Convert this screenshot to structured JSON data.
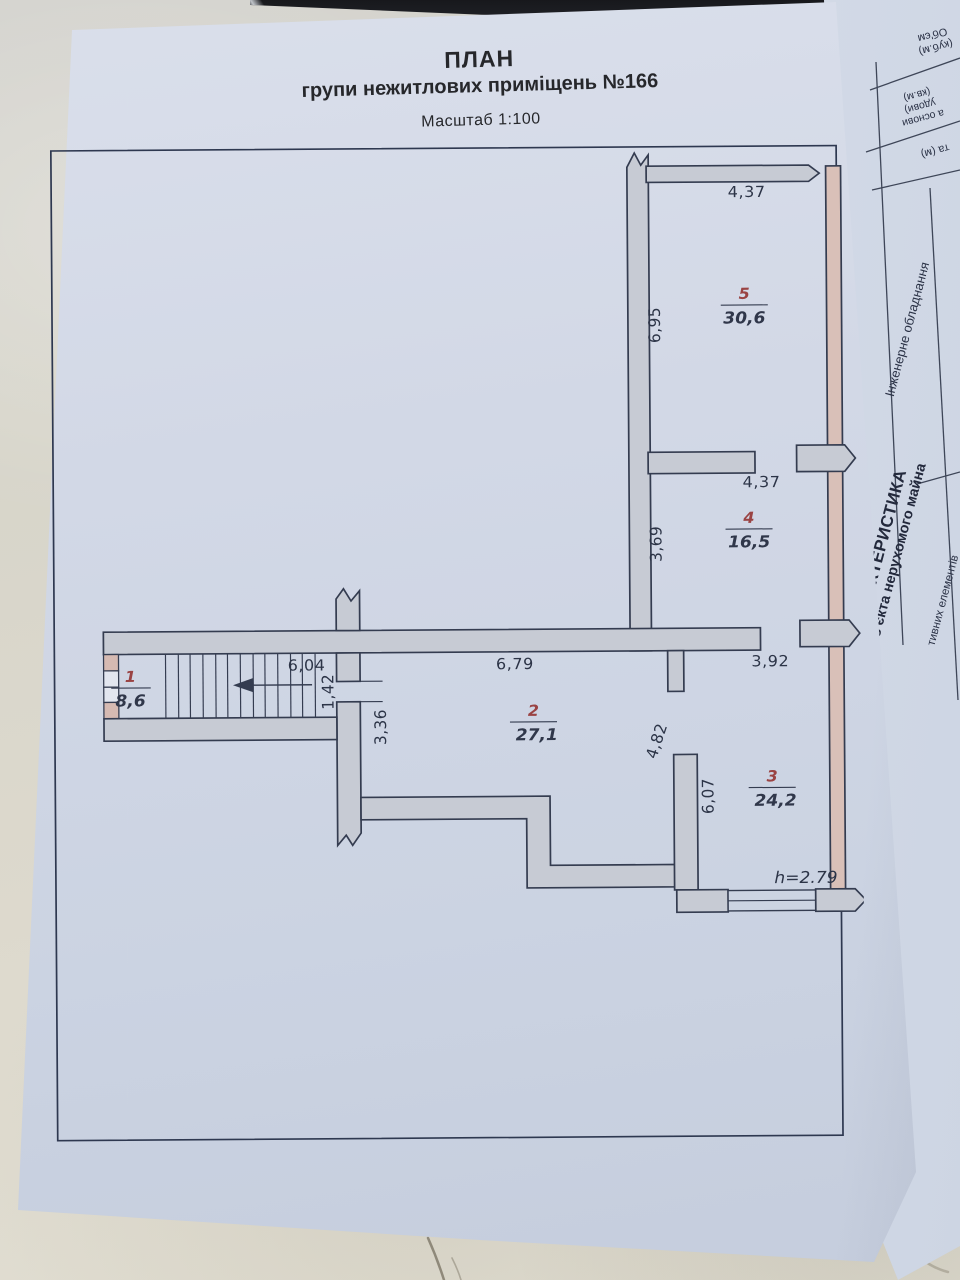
{
  "plan_page": {
    "title": "ПЛАН",
    "subtitle": "групи нежитлових приміщень №166",
    "scale": "Масштаб 1:100",
    "rooms": [
      {
        "number": "1",
        "area": "8,6"
      },
      {
        "number": "2",
        "area": "27,1"
      },
      {
        "number": "3",
        "area": "24,2"
      },
      {
        "number": "4",
        "area": "16,5"
      },
      {
        "number": "5",
        "area": "30,6"
      }
    ],
    "dimensions": {
      "room5_width": "4,37",
      "room5_depth": "6,95",
      "room4_width": "4,37",
      "room4_depth": "3,69",
      "corridor_length": "6,04",
      "passage_width": "1,42",
      "room2_width": "6,79",
      "opening_width": "3,92",
      "room2_left_depth": "3,36",
      "room2_right_depth": "4,82",
      "room3_left_depth": "6,07",
      "ceiling_height": "h=2.79"
    }
  },
  "side_page": {
    "heading_line1": "ХАРАКТЕРИСТИКА",
    "heading_line2": "об'єкта нерухомого майна",
    "row_engineering": "Інженерне обладнання",
    "row_structural_fragment": "тивних елементів",
    "cell_volume_line1": "Об'єм",
    "cell_volume_line2": "(куб.м)",
    "cell_area_line1": "а основи",
    "cell_area_line2": "удови)",
    "cell_area_line3": "(кв.м)",
    "cell_height_fragment": "та (м)"
  },
  "colors": {
    "paper": "#cdd5e3",
    "wall_gray": "#c7cbd4",
    "wall_pink": "#d9c0b8",
    "line_dark": "#343c50",
    "room_number_red": "#9a4343",
    "dimension_text": "#2c3447"
  }
}
